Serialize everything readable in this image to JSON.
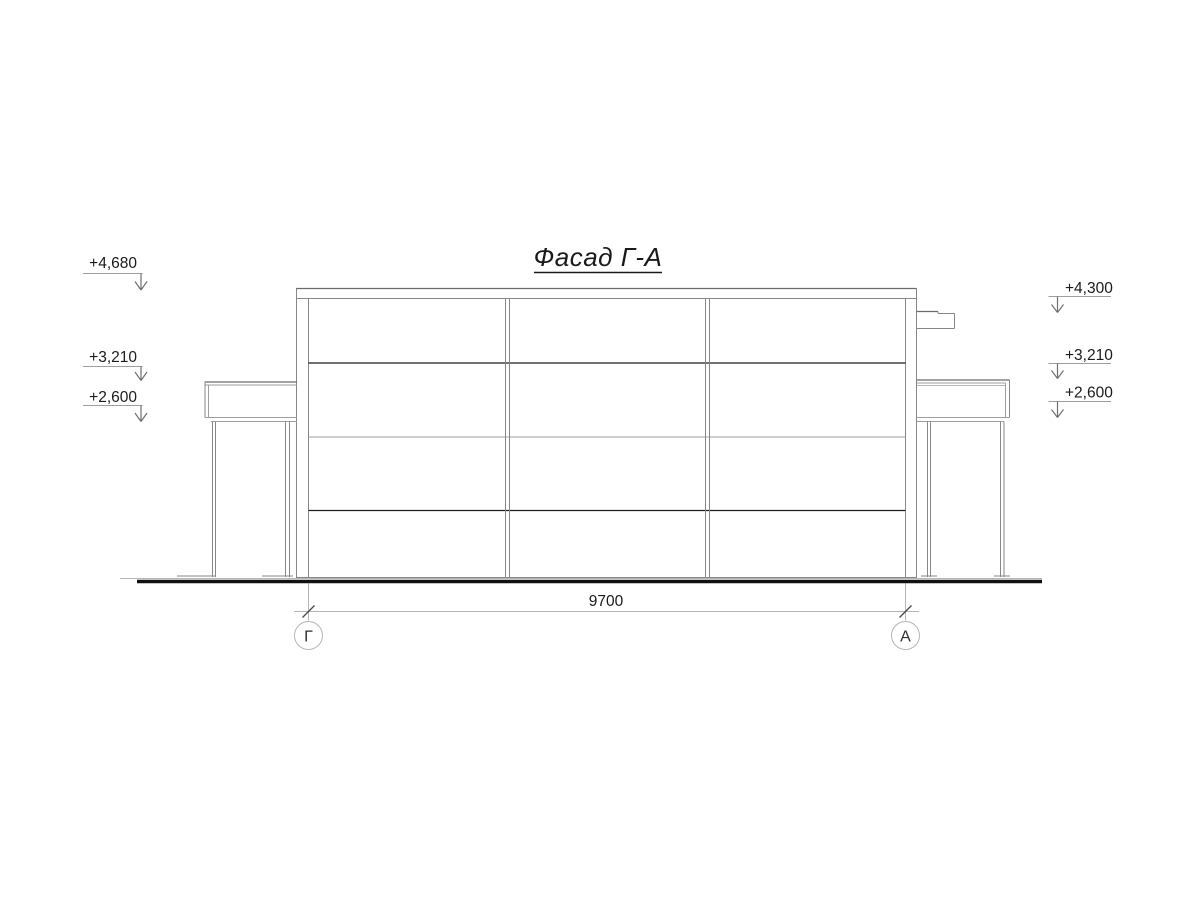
{
  "drawing": {
    "title": "Фасад Г-А",
    "dimension_label": "9700",
    "axis_left": "Г",
    "axis_right": "А",
    "elevations_left": [
      {
        "label": "+4,680"
      },
      {
        "label": "+3,210"
      },
      {
        "label": "+2,600"
      }
    ],
    "elevations_right": [
      {
        "label": "+4,300"
      },
      {
        "label": "+3,210"
      },
      {
        "label": "+2,600"
      }
    ]
  },
  "colors": {
    "background": "#ffffff",
    "line_gray": "#878787",
    "line_dark": "#1c1c1c",
    "line_light": "#b6b6b6",
    "ground": "#111111",
    "text": "#1a1a1a"
  }
}
